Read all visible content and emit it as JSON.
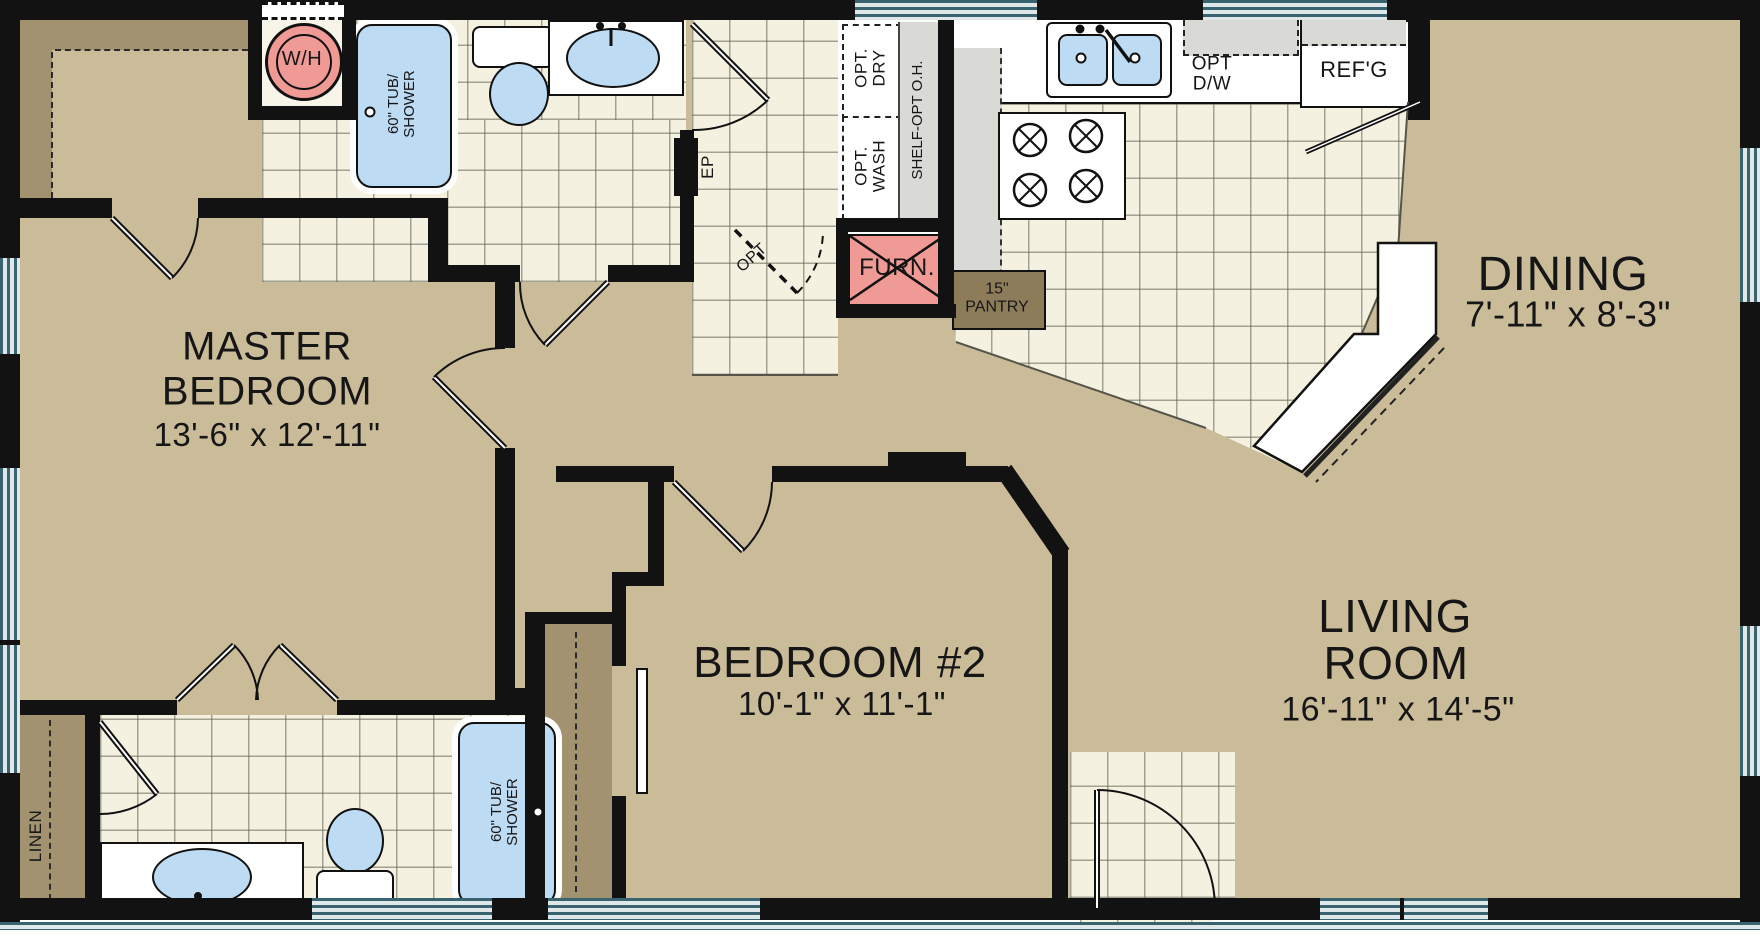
{
  "plan_title": "floor-plan",
  "rooms": {
    "master_bedroom": {
      "name_line1": "MASTER",
      "name_line2": "BEDROOM",
      "dims": "13'-6\" x 12'-11\""
    },
    "bedroom2": {
      "name": "BEDROOM #2",
      "dims": "10'-1\" x 11'-1\""
    },
    "living_room": {
      "name_line1": "LIVING",
      "name_line2": "ROOM",
      "dims": "16'-11\" x 14'-5\""
    },
    "dining": {
      "name": "DINING",
      "dims": "7'-11\" x 8'-3\""
    }
  },
  "fixtures": {
    "water_heater": "W/H",
    "furnace": "FURN.",
    "pantry_size": "15\"",
    "pantry": "PANTRY",
    "refrigerator": "REF'G",
    "dishwasher_line1": "OPT",
    "dishwasher_line2": "D/W",
    "dryer_line1": "OPT.",
    "dryer_line2": "DRY",
    "washer_line1": "OPT.",
    "washer_line2": "WASH",
    "shelf": "SHELF-OPT O.H.",
    "electrical_panel": "EP",
    "optional_door": "OPT",
    "linen": "LINEN",
    "tub_line1": "60\" TUB/",
    "tub_line2": "SHOWER"
  },
  "colors": {
    "floor_tan": "#cbbc99",
    "closet_tan": "#a3926f",
    "tile": "#f5f1e1",
    "wall": "#121212",
    "window_teal": "#38636f",
    "fixture_pink": "#f09a96",
    "fixture_blue": "#bedbf4",
    "counter_gray": "#d9d9d6",
    "pantry_brown": "#8d7c5a"
  }
}
